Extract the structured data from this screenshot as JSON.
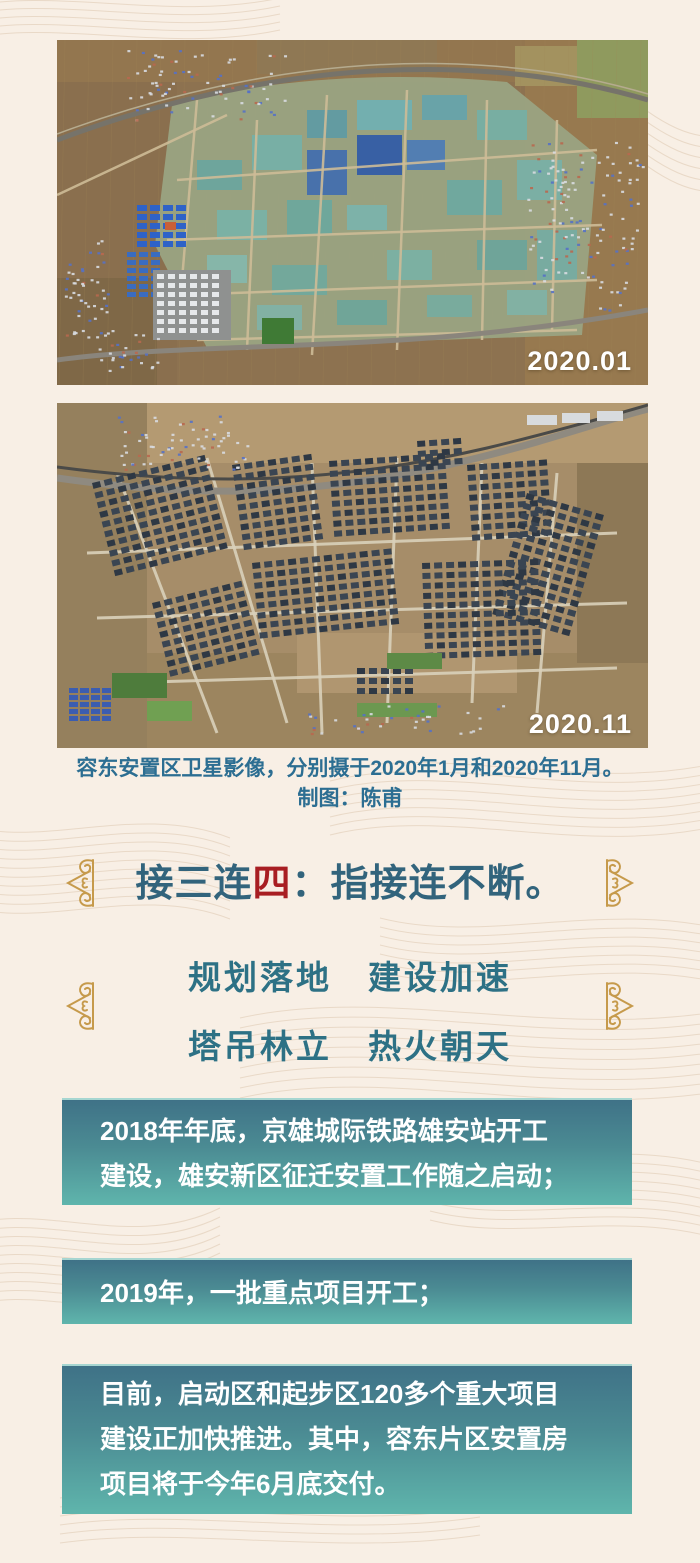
{
  "photos": [
    {
      "name": "satellite-2020-01",
      "date_label": "2020.01"
    },
    {
      "name": "satellite-2020-11",
      "date_label": "2020.11"
    }
  ],
  "caption": {
    "line1": "容东安置区卫星影像，分别摄于2020年1月和2020年11月。",
    "line2": "制图：陈甫"
  },
  "heading": {
    "pre": "接三连",
    "em": "四",
    "post": "：指接连不断。"
  },
  "slogans": {
    "line1": "规划落地　建设加速",
    "line2": "塔吊林立　热火朝天"
  },
  "info_boxes": [
    {
      "lines": [
        "2018年年底，京雄城际铁路雄安站开工",
        "建设，雄安新区征迁安置工作随之启动；"
      ]
    },
    {
      "lines": [
        "2019年，一批重点项目开工；"
      ]
    },
    {
      "lines": [
        "目前，启动区和起步区120多个重大项目",
        "建设正加快推进。其中，容东片区安置房",
        "项目将于今年6月底交付。"
      ]
    }
  ],
  "colors": {
    "page_background": "#f8efe5",
    "caption_teal": "#2c6e92",
    "heading_teal": "#32647c",
    "highlight_red": "#a81e22",
    "slogan_teal": "#2d7185",
    "ornament_gold": "#c69a4b",
    "box_gradient_top": "#3f7287",
    "box_gradient_bottom": "#5fb5ac",
    "box_text": "#ffffff"
  }
}
